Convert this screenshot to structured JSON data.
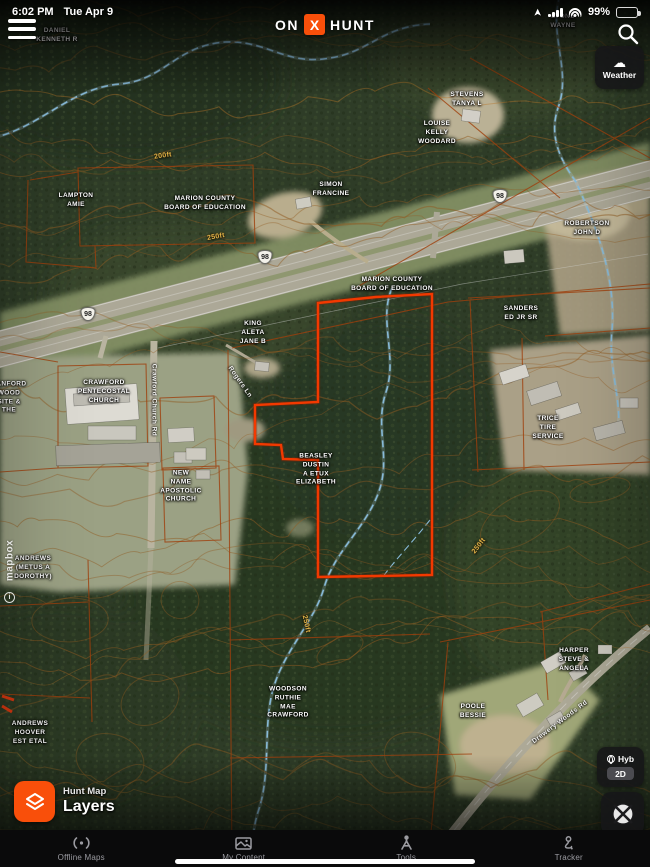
{
  "status_bar": {
    "time": "6:02 PM",
    "date": "Tue Apr 9",
    "battery_percent": "99%",
    "icons": [
      "location-arrow-icon",
      "cellular-signal-icon",
      "wifi-icon",
      "battery-icon"
    ]
  },
  "header": {
    "logo": {
      "on": "ON",
      "x": "X",
      "hunt": "HUNT",
      "x_box_color": "#f94f0a"
    },
    "menu_icon": "hamburger-menu-icon",
    "search_icon": "search-icon"
  },
  "weather_button": {
    "label": "Weather",
    "icon": "cloud-icon"
  },
  "layers_button": {
    "small_label": "Hunt Map",
    "big_label": "Layers",
    "icon": "layers-icon",
    "color": "#f94f0a"
  },
  "map_mode_control": {
    "top_label": "Hyb",
    "top_icon": "globe-icon",
    "bottom_label": "2D"
  },
  "crosshair_button": {
    "icon": "locate-crosshair-icon"
  },
  "watermark": {
    "text": "mapbox",
    "info": "i"
  },
  "bottom_nav": {
    "items": [
      {
        "label": "Offline Maps",
        "icon": "offline-maps-icon"
      },
      {
        "label": "My Content",
        "icon": "my-content-icon"
      },
      {
        "label": "Tools",
        "icon": "tools-icon"
      },
      {
        "label": "Tracker",
        "icon": "tracker-icon"
      }
    ]
  },
  "map": {
    "colors": {
      "highlight_boundary": "#ff3d00",
      "cadastral_line": "#a8430e",
      "contour_line": "#9a6224",
      "stream": "#8fc4e4",
      "forest_base": "#31402a",
      "highway": "#b6b2a0"
    },
    "parcel_labels": [
      {
        "t": "DANIEL\nKENNETH R",
        "x": 57,
        "y": 36
      },
      {
        "t": "LYONS\nWAYNE",
        "x": 563,
        "y": 22
      },
      {
        "t": "STEVENS\nTANYA L",
        "x": 467,
        "y": 100
      },
      {
        "t": "LOUISE\nKELLY\nWOODARD",
        "x": 437,
        "y": 133
      },
      {
        "t": "LAMPTON\nAMIE",
        "x": 76,
        "y": 201
      },
      {
        "t": "MARION COUNTY\nBOARD OF EDUCATION",
        "x": 205,
        "y": 204
      },
      {
        "t": "SIMON\nFRANCINE",
        "x": 331,
        "y": 190
      },
      {
        "t": "ROBERTSON\nJOHN D",
        "x": 587,
        "y": 229
      },
      {
        "t": "MARION COUNTY\nBOARD OF EDUCATION",
        "x": 392,
        "y": 285
      },
      {
        "t": "KING\nALETA\nJANE B",
        "x": 253,
        "y": 333
      },
      {
        "t": "SANDERS\nED JR SR",
        "x": 521,
        "y": 314
      },
      {
        "t": "SANFORD\nWOOD\nSITE &\nTHE",
        "x": 9,
        "y": 398
      },
      {
        "t": "CRAWFORD\nPENTECOSTAL\nCHURCH",
        "x": 104,
        "y": 392
      },
      {
        "t": "NEW\nNAME\nAPOSTOLIC\nCHURCH",
        "x": 181,
        "y": 487
      },
      {
        "t": "BEASLEY\nDUSTIN\nA ETUX\nELIZABETH",
        "x": 316,
        "y": 470
      },
      {
        "t": "TRICE\nTIRE\nSERVICE",
        "x": 548,
        "y": 428
      },
      {
        "t": "ANDREWS\n(METUS A\nDOROTHY)",
        "x": 33,
        "y": 568
      },
      {
        "t": "WOODSON\nRUTHIE\nMAE\nCRAWFORD",
        "x": 288,
        "y": 703
      },
      {
        "t": "ANDREWS\nHOOVER\nEST ETAL",
        "x": 30,
        "y": 733
      },
      {
        "t": "POOLE\nBESSIE",
        "x": 473,
        "y": 712
      },
      {
        "t": "HARPER\nSTEVE &\nANGELA",
        "x": 574,
        "y": 660
      }
    ],
    "contour_labels": [
      {
        "t": "200ft",
        "x": 163,
        "y": 156,
        "rot": -8
      },
      {
        "t": "250ft",
        "x": 216,
        "y": 237,
        "rot": -10
      },
      {
        "t": "250ft",
        "x": 479,
        "y": 546,
        "rot": -52
      },
      {
        "t": "250ft",
        "x": 306,
        "y": 624,
        "rot": 78
      }
    ],
    "road_labels": [
      {
        "t": "Rogers Ln",
        "x": 240,
        "y": 382,
        "rot": 55
      },
      {
        "t": "Crawford Church Rd",
        "x": 154,
        "y": 400,
        "rot": 90
      },
      {
        "t": "Drewery Woods Rd",
        "x": 560,
        "y": 722,
        "rot": -37
      }
    ],
    "route_shields": [
      {
        "n": "98",
        "x": 500,
        "y": 196
      },
      {
        "n": "98",
        "x": 265,
        "y": 257
      },
      {
        "n": "98",
        "x": 88,
        "y": 314
      }
    ]
  }
}
